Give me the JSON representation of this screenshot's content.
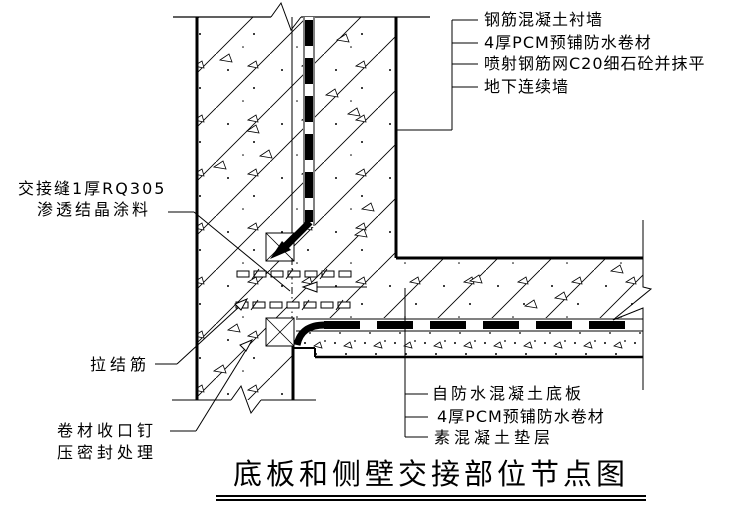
{
  "title": "底板和侧壁交接部位节点图",
  "callouts": {
    "wall": [
      "钢筋混凝土衬墙",
      "4厚PCM预铺防水卷材",
      "喷射钢筋网C20细石砼并抹平",
      "地下连续墙"
    ],
    "seam": [
      "交接缝1厚RQ305",
      "渗透结晶涂料"
    ],
    "tie_bar": "拉结筋",
    "membrane_end": [
      "卷材收口钉",
      "压密封处理"
    ],
    "slab": [
      "自防水混凝土底板",
      "4厚PCM预铺防水卷材",
      "素混凝土垫层"
    ]
  },
  "colors": {
    "line": "#000000",
    "background": "#ffffff"
  }
}
